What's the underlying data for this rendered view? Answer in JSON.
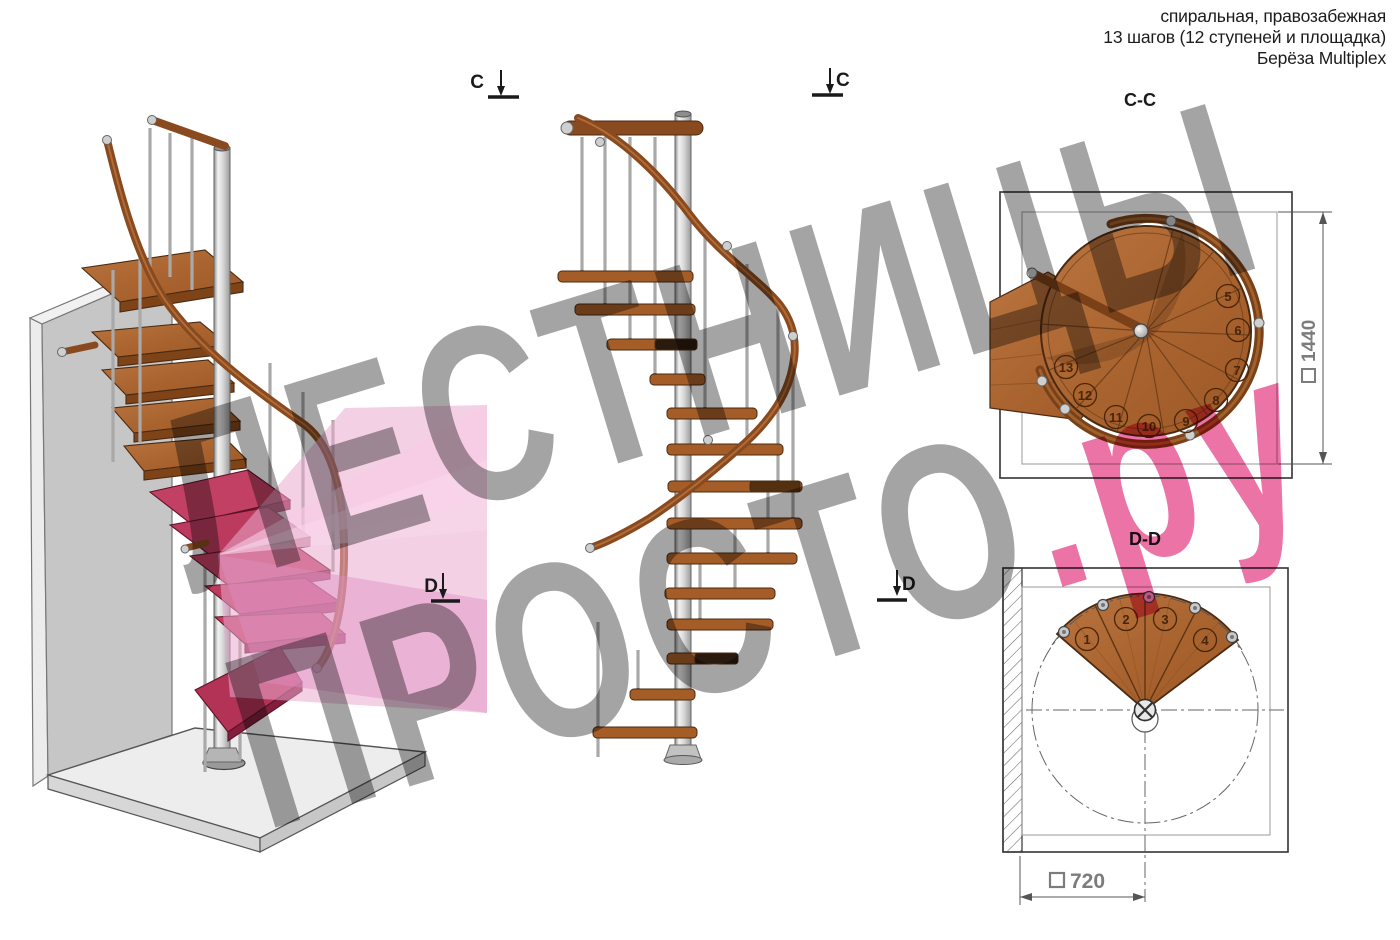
{
  "header": {
    "line1": "спиральная, правозабежная",
    "line2": "13 шагов (12 ступеней и площадка)",
    "line3": "Берёза Multiplex"
  },
  "watermark": {
    "line1": "ЛЕСТНИЦЫ",
    "line2_gray": "ПРОСТО",
    "line2_pink": ".ру"
  },
  "section_markers": {
    "c": "C",
    "d": "D"
  },
  "views": {
    "cc": {
      "title": "C-C",
      "dimension": "1440",
      "steps": [
        "5",
        "6",
        "7",
        "8",
        "9",
        "10",
        "11",
        "12",
        "13"
      ]
    },
    "dd": {
      "title": "D-D",
      "dimension": "720",
      "steps": [
        "1",
        "2",
        "3",
        "4"
      ]
    }
  },
  "colors": {
    "wood": "#a55d28",
    "handrail": "#8a4a1f",
    "metal": "#c9c9c9",
    "section_plane_pink": "#efaed3",
    "tinted_step": "#b93a5c",
    "watermark_gray": "#8a8a8a",
    "watermark_pink": "#e75a96",
    "dimension_gray": "#7c7c7c"
  }
}
